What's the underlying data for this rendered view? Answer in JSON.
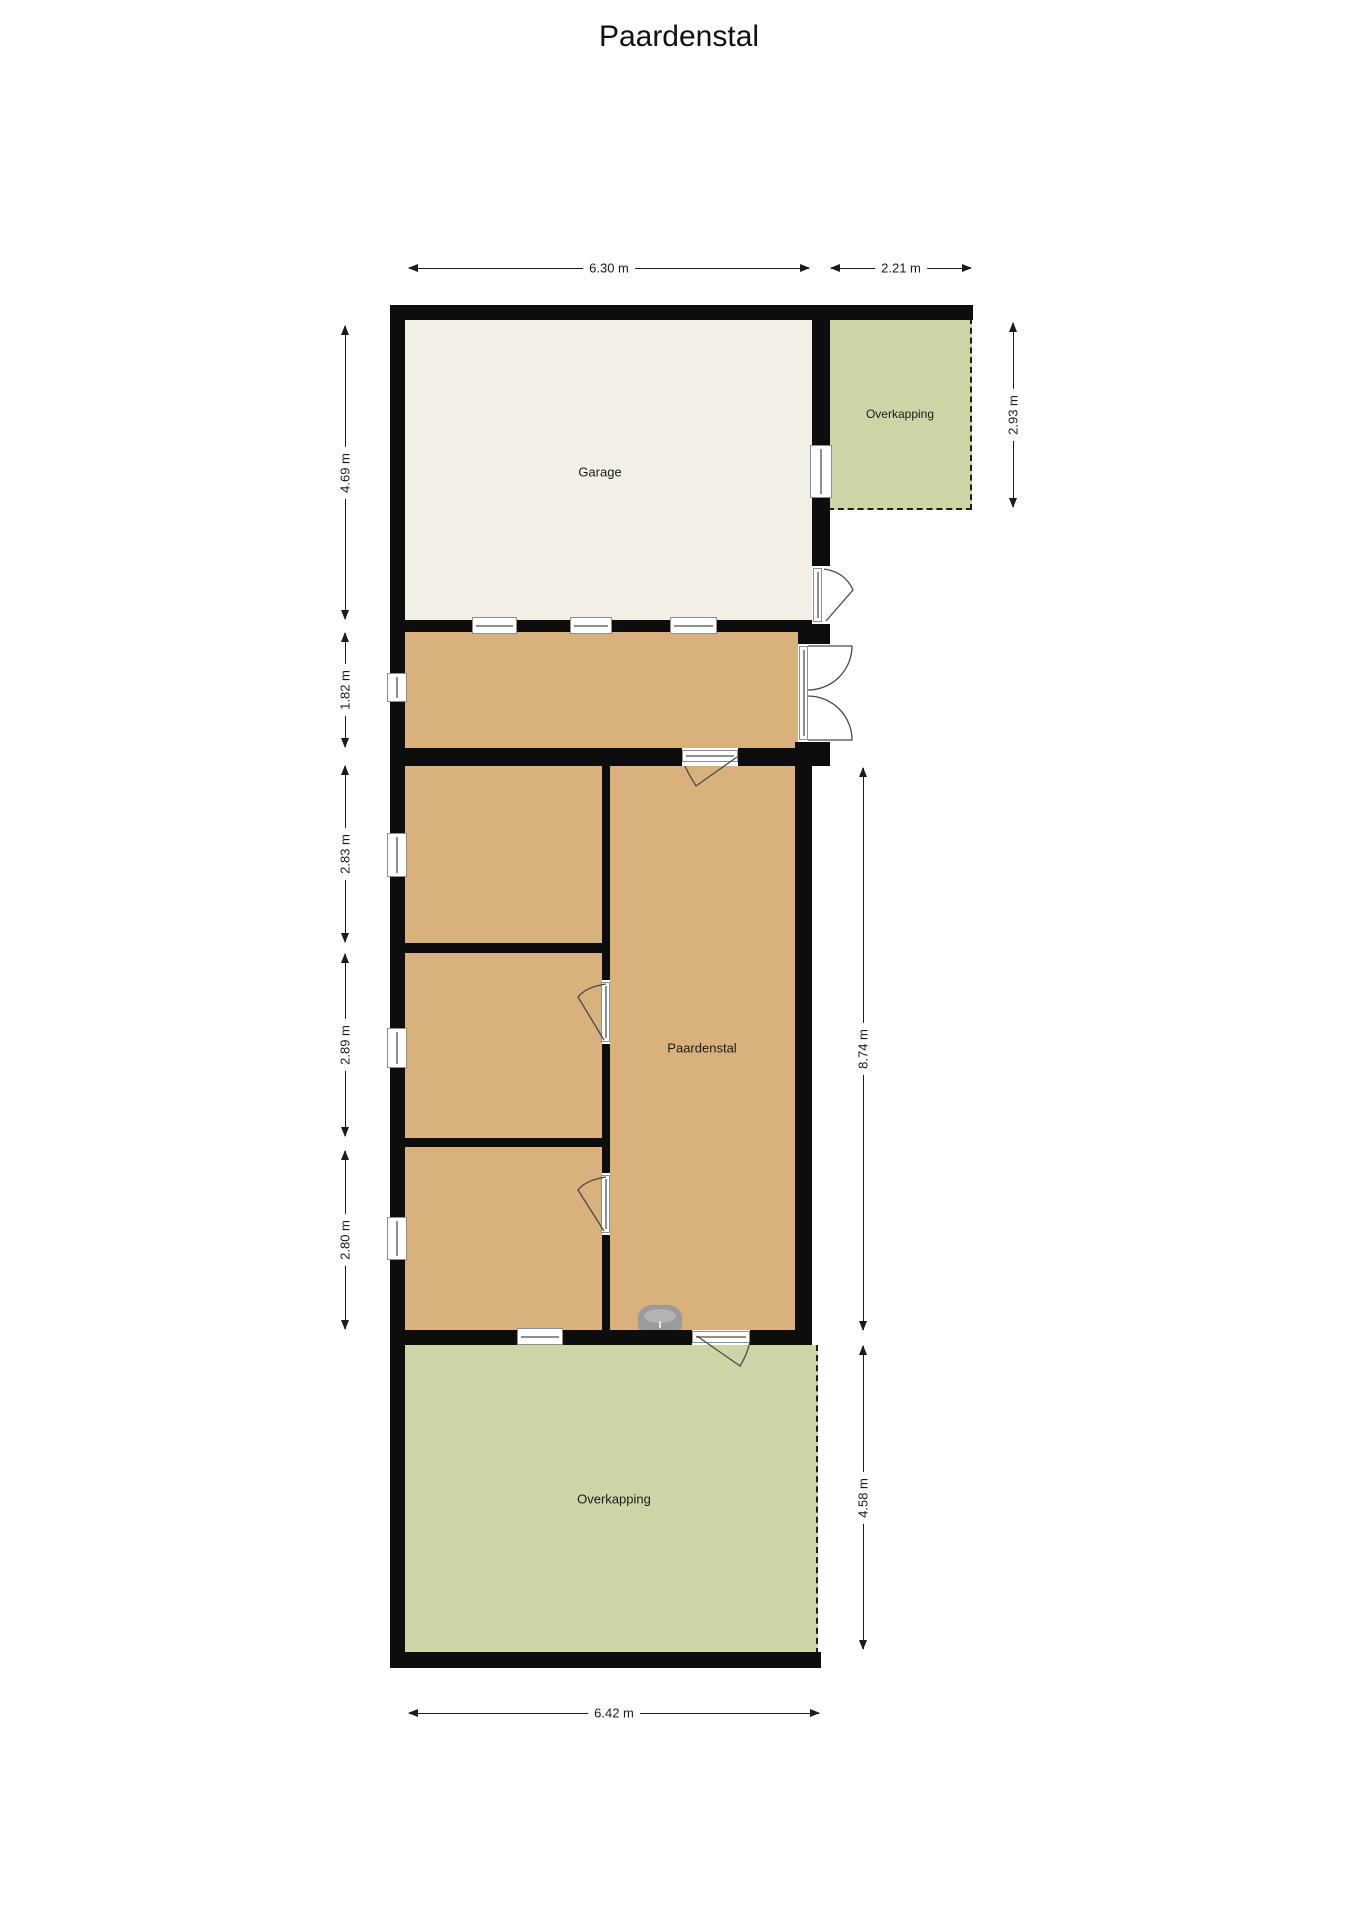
{
  "title": "Paardenstal",
  "colors": {
    "bg": "#ffffff",
    "wall": "#0d0d0d",
    "cream": "#f2f0e6",
    "tan": "#d9b17d",
    "green": "#ccd5a6",
    "ink": "#1b1b1b",
    "winframe": "#8f8f8f",
    "fixture": "#9b9b9b",
    "door": "#4a4a4a"
  },
  "rooms": {
    "garage": {
      "label": "Garage"
    },
    "overkapping_top": {
      "label": "Overkapping"
    },
    "paardenstal": {
      "label": "Paardenstal"
    },
    "overkapping_bottom": {
      "label": "Overkapping"
    }
  },
  "dimensions": {
    "garage_width": "6.30 m",
    "overkapping_top_width": "2.21 m",
    "garage_height": "4.69 m",
    "overkapping_top_height": "2.93 m",
    "corridor_height": "1.82 m",
    "stall1_height": "2.83 m",
    "stall2_height": "2.89 m",
    "stall3_height": "2.80 m",
    "paardenstal_height": "8.74 m",
    "overkapping_bottom_height": "4.58 m",
    "bottom_width": "6.42 m"
  }
}
